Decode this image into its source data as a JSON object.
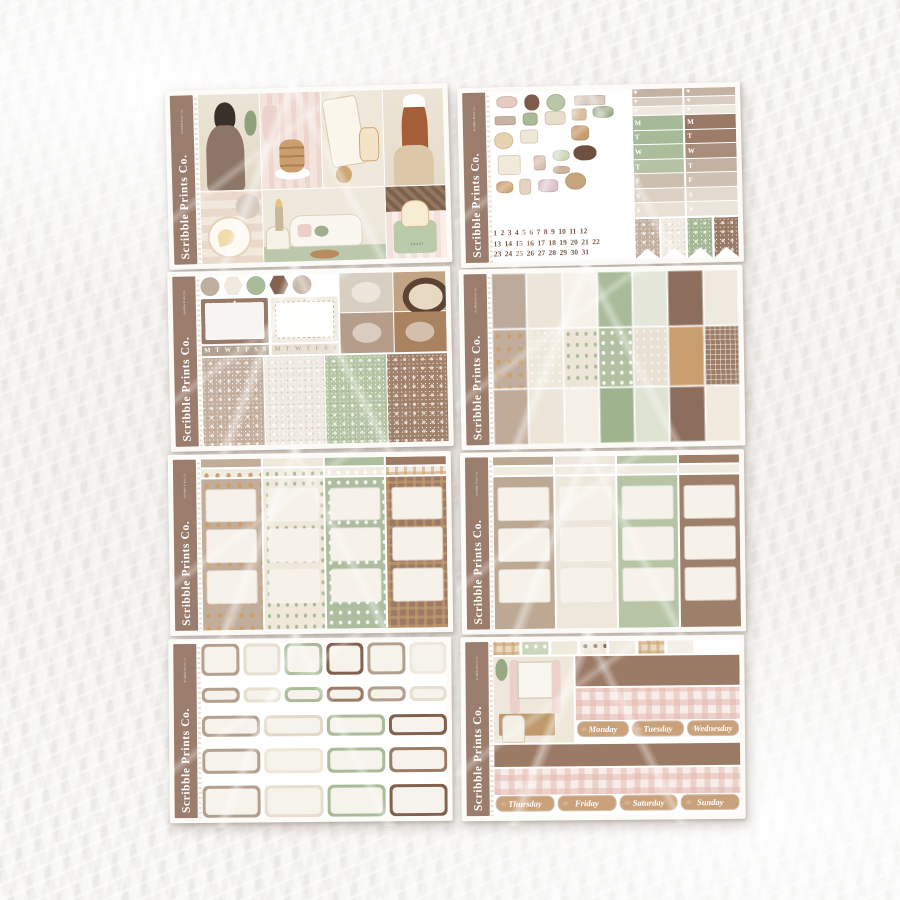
{
  "brand": {
    "name": "Scribble Prints Co.",
    "edge_label": "Scribble Prints Co."
  },
  "symbols": {
    "heart": "♥",
    "star": "★"
  },
  "palette": {
    "band_brown": "#9b7d6d",
    "brown_dark": "#83614f",
    "brown": "#9c7c66",
    "taupe": "#bfab9b",
    "cream": "#ece5d8",
    "off_white": "#f6f2ea",
    "sage": "#a9bb99",
    "gold": "#c9a06b",
    "pink": "#f3e0da"
  },
  "weekday_letters": [
    "M",
    "T",
    "W",
    "T",
    "F",
    "S",
    "S"
  ],
  "sheet1": {
    "toaster_label": "TOAST"
  },
  "sheet2": {
    "heart_strip_colors": [
      "#c4b2a3",
      "#d9cdc1",
      "#efe9e0"
    ],
    "col1_letter_colors": [
      "#a7ba97",
      "#a7ba97",
      "#abbd9b",
      "#b6c2a6",
      "#cdbfb0",
      "#dbd0c3",
      "#e9e1d6"
    ],
    "col2_letter_colors": [
      "#9a7a66",
      "#9d7d69",
      "#a88d7b",
      "#c3b1a3",
      "#cfc1b3",
      "#e3dacd",
      "#ece5da"
    ],
    "flag_colors": [
      "#c3b1a1",
      "#f0eae0",
      "#a7ba97",
      "#9a7a66"
    ],
    "date_rows": [
      "1 2 3 4 5 6 7 8 9 10 11 12",
      "13 14 15 16 17 18 19 20 21 22",
      "23 24 25 26 27 28 29 30 31"
    ],
    "deco_stickers": [
      {
        "n": "slippers-pink",
        "c": "#e5cbc4",
        "x": 4,
        "y": 3,
        "w": 15,
        "h": 10,
        "r": "40%"
      },
      {
        "n": "teddy-bear",
        "c": "#7c5c4a",
        "x": 24,
        "y": 2,
        "w": 11,
        "h": 13,
        "r": "45%"
      },
      {
        "n": "breakfast-plate",
        "c": "#b9c7a9",
        "x": 40,
        "y": 2,
        "w": 14,
        "h": 14,
        "r": "50%"
      },
      {
        "n": "washi-sample",
        "c": "#d9cbbc",
        "x": 60,
        "y": 4,
        "w": 22,
        "h": 8,
        "r": "10%"
      },
      {
        "n": "switch-console",
        "c": "#c7b3a3",
        "x": 3,
        "y": 19,
        "w": 15,
        "h": 7,
        "r": "15%"
      },
      {
        "n": "game-controller-green",
        "c": "#a9ba98",
        "x": 23,
        "y": 17,
        "w": 11,
        "h": 10,
        "r": "30%"
      },
      {
        "n": "toaster",
        "c": "#e9decb",
        "x": 39,
        "y": 16,
        "w": 15,
        "h": 11,
        "r": "25%"
      },
      {
        "n": "cake-slice",
        "c": "#d9bf9f",
        "x": 58,
        "y": 14,
        "w": 11,
        "h": 10,
        "r": "20%"
      },
      {
        "n": "slippers-green",
        "c": "#9fae8e",
        "x": 73,
        "y": 13,
        "w": 15,
        "h": 9,
        "r": "40%"
      },
      {
        "n": "egg-plate",
        "c": "#e6d3b0",
        "x": 2,
        "y": 32,
        "w": 14,
        "h": 13,
        "r": "50%"
      },
      {
        "n": "folded-blanket",
        "c": "#efe7d6",
        "x": 21,
        "y": 30,
        "w": 13,
        "h": 11,
        "r": "20%"
      },
      {
        "n": "pancake-stack",
        "c": "#c79d6f",
        "x": 57,
        "y": 28,
        "w": 13,
        "h": 12,
        "r": "30%"
      },
      {
        "n": "pajama-shirt",
        "c": "#f2ead9",
        "x": 4,
        "y": 50,
        "w": 17,
        "h": 16,
        "r": "15%"
      },
      {
        "n": "mug",
        "c": "#d8c0b4",
        "x": 30,
        "y": 51,
        "w": 9,
        "h": 12,
        "r": "20%"
      },
      {
        "n": "cat-ear-headphones",
        "c": "#ccd7bc",
        "x": 44,
        "y": 47,
        "w": 12,
        "h": 9,
        "r": "40%"
      },
      {
        "n": "chocolate-roll",
        "c": "#6f4f3e",
        "x": 59,
        "y": 44,
        "w": 16,
        "h": 12,
        "r": "45%"
      },
      {
        "n": "glasses",
        "c": "#cdb59f",
        "x": 44,
        "y": 60,
        "w": 12,
        "h": 6,
        "r": "40%"
      },
      {
        "n": "croissant",
        "c": "#cfa676",
        "x": 3,
        "y": 71,
        "w": 12,
        "h": 9,
        "r": "40%"
      },
      {
        "n": "water-flask",
        "c": "#e2d4bf",
        "x": 19,
        "y": 69,
        "w": 9,
        "h": 13,
        "r": "25%"
      },
      {
        "n": "game-controller-pink",
        "c": "#dcc3cb",
        "x": 33,
        "y": 70,
        "w": 14,
        "h": 10,
        "r": "30%"
      },
      {
        "n": "cinnamon-roll",
        "c": "#c7a57c",
        "x": 52,
        "y": 65,
        "w": 15,
        "h": 14,
        "r": "50%"
      }
    ]
  },
  "sheet3": {
    "shape_row": [
      {
        "s": "c",
        "c": "#c0ae9e",
        "n": "circle-taupe-glitter"
      },
      {
        "s": "h",
        "c": "#f0e9dd",
        "n": "hexagon-cream"
      },
      {
        "s": "c",
        "c": "#a9bb99",
        "n": "circle-sage"
      },
      {
        "s": "h",
        "c": "#83624f",
        "n": "hexagon-brown"
      },
      {
        "s": "c",
        "c": "#c7b6a8",
        "n": "circle-taupe"
      }
    ],
    "marquees": [
      {
        "bg": "#997a68",
        "light": false
      },
      {
        "bg": "#f2ece2",
        "light": true
      }
    ],
    "letter_strips": [
      {
        "bg": "#b2a090",
        "fg": "#ffffff"
      },
      {
        "bg": "#e9e1d4",
        "fg": "#c0b09c"
      }
    ],
    "photos": [
      {
        "n": "desk-scene",
        "c": "#d8cfc2"
      },
      {
        "n": "hamster-bed",
        "c": "#c2a383"
      },
      {
        "n": "gaming-hands",
        "c": "#b59d89"
      },
      {
        "n": "cinnamon-bun",
        "c": "#a9825f"
      }
    ],
    "glitter_colors": [
      "#c6b1a1",
      "#efe9e2",
      "#b7c6a6",
      "#a3826c"
    ]
  },
  "sheet4": {
    "rows": [
      [
        "#bcab9b",
        "#ece5d8",
        "#f6f2ea",
        "#a9bb99",
        "#e4e7da",
        "#8d6e5c",
        "#efe9df"
      ],
      [
        "#c2ad9c",
        "#efe8dc",
        "#ede6d8",
        "#b3c0a2",
        "#e9e1d3",
        "#c99e6f",
        "#9c7c66"
      ],
      [
        "#c0ab99",
        "#ece5d8",
        "#f4efe7",
        "#9fb38e",
        "#dfe3d2",
        "#8d6e5c",
        "#f0eadf"
      ]
    ],
    "row2_patterns": [
      "p-gold",
      "p-dots",
      "p-sprig",
      "p-heart",
      "p-dots",
      "p-plaid",
      "p-grid"
    ]
  },
  "sheet5": {
    "columns": [
      {
        "c": "#c2ad9b",
        "p": "p-gold",
        "n": "taupe-butterfly-column"
      },
      {
        "c": "#efe8db",
        "p": "p-sprig",
        "n": "cream-sprig-column"
      },
      {
        "c": "#aebd9e",
        "p": "p-heart",
        "n": "sage-heart-column"
      },
      {
        "c": "#9c7a64",
        "p": "p-plaid",
        "n": "brown-plaid-column"
      }
    ]
  },
  "sheet6": {
    "columns": [
      "#bca893",
      "#eee7db",
      "#b7c5a6",
      "#9d7f6a"
    ]
  },
  "sheet7": {
    "rows": [
      {
        "h": 32,
        "c": [
          "#b3a08e",
          "#e7dfcf",
          "#a9bb99",
          "#83614f",
          "#b3a08e",
          "#efe9dd"
        ]
      },
      {
        "h": 15,
        "c": [
          "#b3a08e",
          "#e7dfcf",
          "#a9bb99",
          "#9c7c66",
          "#b3a08e",
          "#e7dfcf"
        ]
      },
      {
        "h": 21,
        "c": [
          "#b3a08e",
          "#e3d9c8",
          "#a9bb99",
          "#83614f"
        ]
      },
      {
        "h": 25,
        "c": [
          "#b3a08e",
          "#efe7d8",
          "#a9bb99",
          "#9c7c66"
        ]
      },
      {
        "h": 32,
        "c": [
          "#b3a08e",
          "#e7dfcf",
          "#a9bb99",
          "#83614f"
        ]
      }
    ]
  },
  "sheet8": {
    "washi": [
      {
        "c": "#ecd9c2",
        "p": "p-plaid",
        "n": "plaid-washi"
      },
      {
        "c": "#cbd6bd",
        "p": "p-heart",
        "n": "sage-heart-washi"
      },
      {
        "c": "#f0ebdf",
        "p": "",
        "n": "cream-washi"
      },
      {
        "c": "#efe8d9",
        "p": "p-bear",
        "n": "bear-washi"
      },
      {
        "c": "#f0ebdf",
        "p": "",
        "n": "cream-washi"
      },
      {
        "c": "#ecd9c2",
        "p": "p-plaid",
        "n": "plaid-washi"
      },
      {
        "c": "#f4f0e8",
        "p": "",
        "n": "cream-washi"
      }
    ],
    "strip_brown": "#9b7a66",
    "day_row1": [
      "Monday",
      "Tuesday",
      "Wednesday"
    ],
    "day_row2": [
      "Thursday",
      "Friday",
      "Saturday",
      "Sunday"
    ]
  }
}
